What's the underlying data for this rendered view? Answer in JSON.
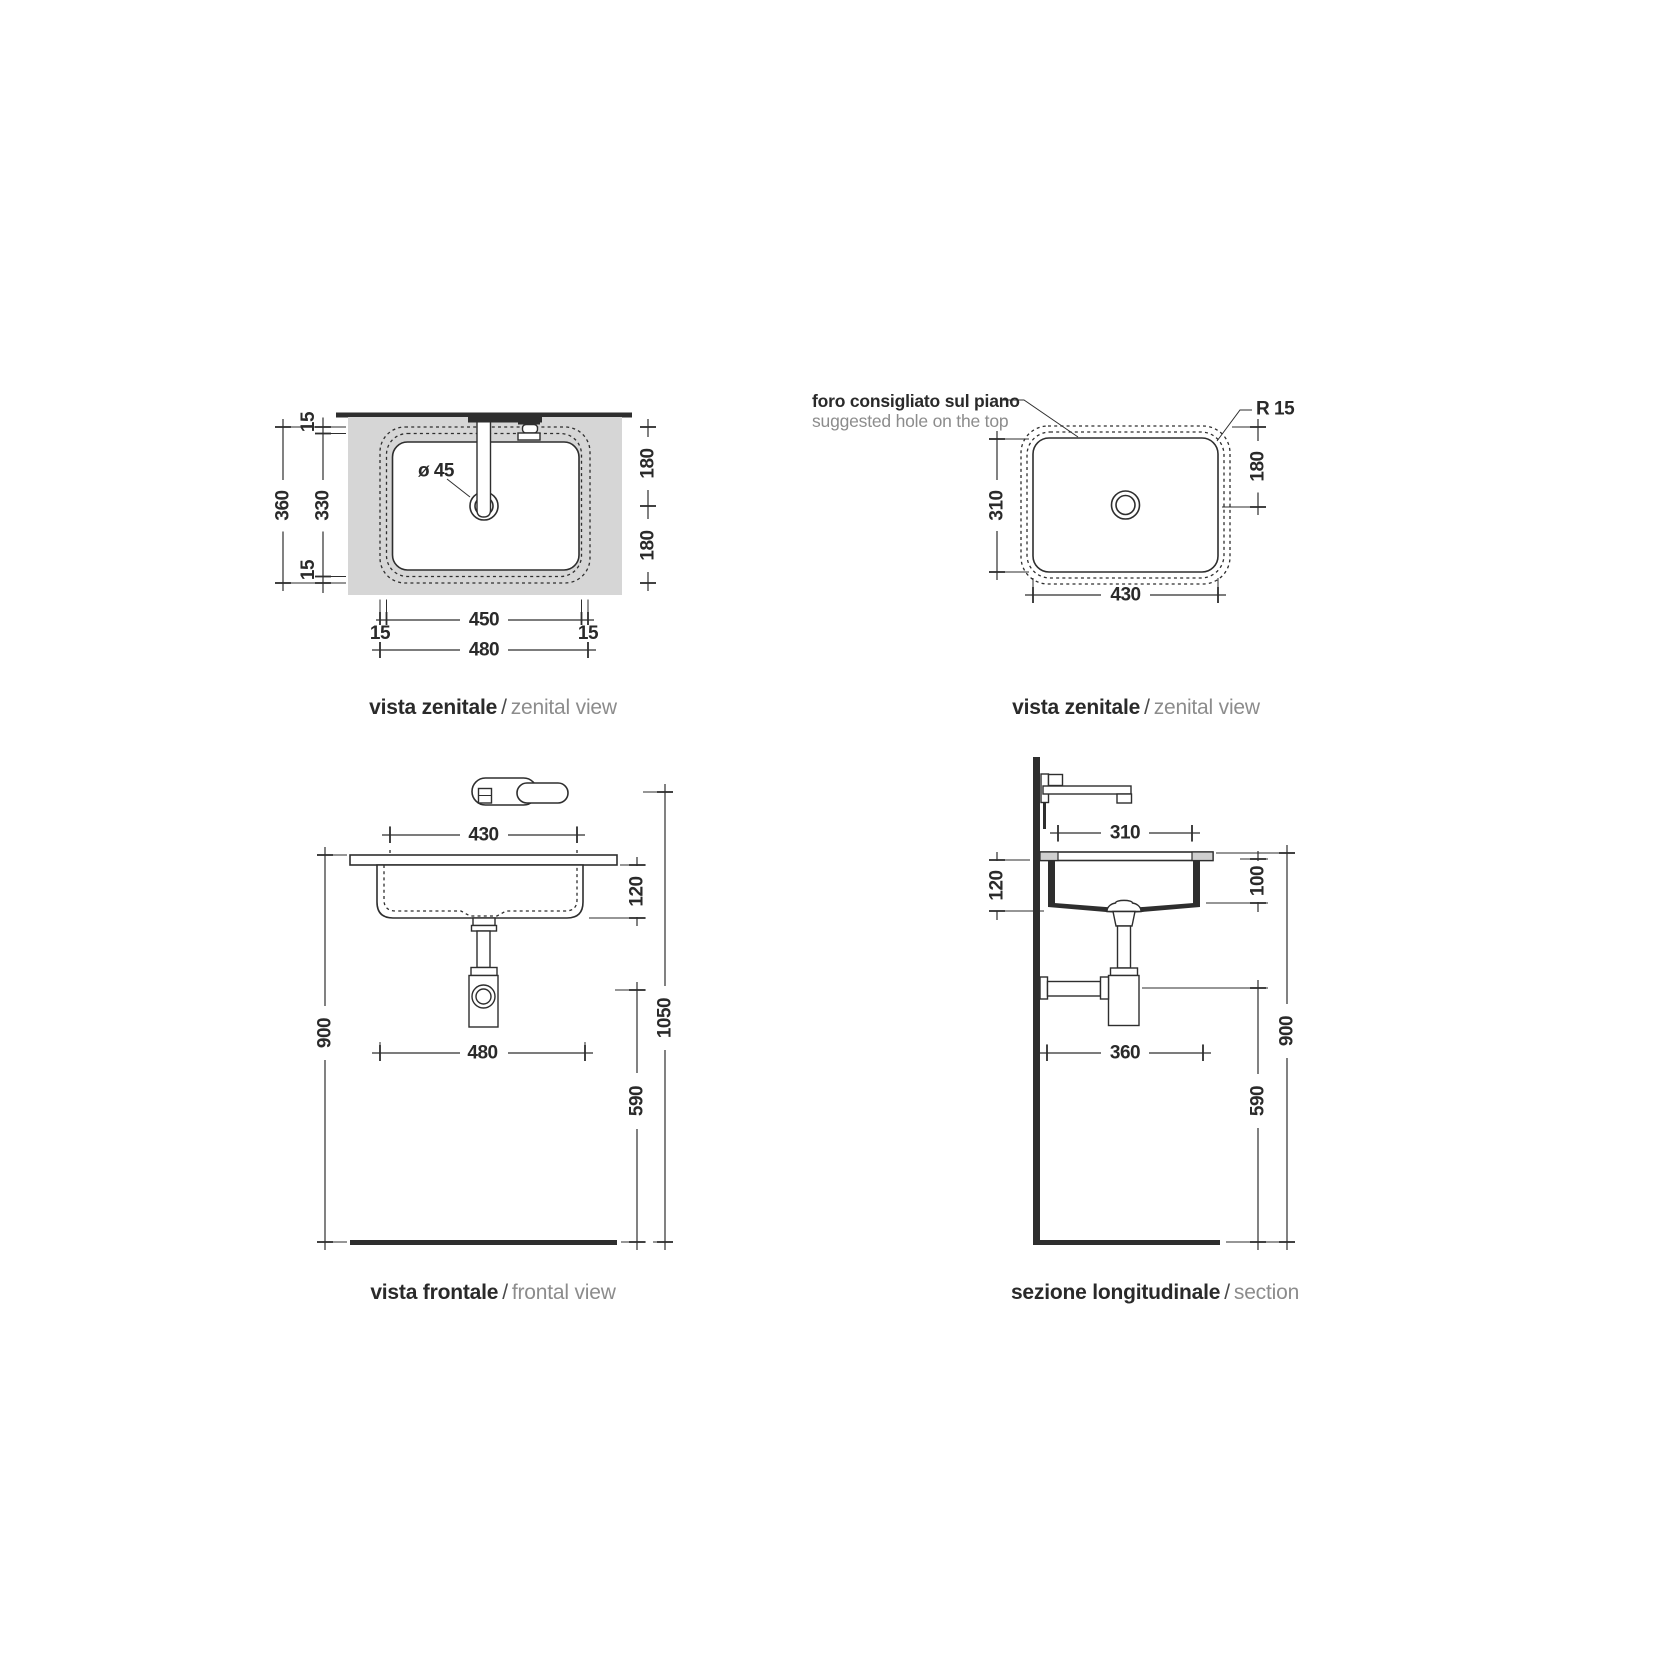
{
  "palette": {
    "line_color": "#2e2e2e",
    "text_color": "#2a2a2a",
    "counter_fill": "#d6d6d6",
    "cut_fill": "#cfcfcf",
    "secondary_text_color": "#8c8c8c",
    "background": "#ffffff"
  },
  "views": {
    "zenital_left": {
      "caption": {
        "primary": "vista zenitale",
        "separator": "/",
        "secondary": "zenital view"
      },
      "dims": {
        "overall_depth": "360",
        "hole_depth": "330",
        "edge_gap_top": "15",
        "edge_gap_bottom": "15",
        "drain_offset_upper": "180",
        "drain_offset_lower": "180",
        "drain_diameter": "ø 45",
        "hole_width": "450",
        "edge_gap_left": "15",
        "edge_gap_right": "15",
        "overall_width": "480"
      }
    },
    "zenital_right": {
      "note": {
        "primary": "foro consigliato sul piano",
        "secondary": "suggested hole on the top"
      },
      "corner_radius_label": "R 15",
      "dims": {
        "basin_depth": "310",
        "drain_offset": "180",
        "basin_width": "430"
      },
      "caption": {
        "primary": "vista zenitale",
        "separator": "/",
        "secondary": "zenital view"
      }
    },
    "frontal": {
      "dims": {
        "rim_width": "430",
        "basin_height": "120",
        "counter_height": "900",
        "overall_width": "480",
        "faucet_height": "1050",
        "drain_height": "590"
      },
      "caption": {
        "primary": "vista frontale",
        "separator": "/",
        "secondary": "frontal view"
      }
    },
    "section": {
      "dims": {
        "hole_depth": "310",
        "basin_height": "120",
        "inner_depth": "100",
        "overall_depth": "360",
        "counter_height": "900",
        "drain_height": "590"
      },
      "caption": {
        "primary": "sezione longitudinale",
        "separator": "/",
        "secondary": "section"
      }
    }
  }
}
